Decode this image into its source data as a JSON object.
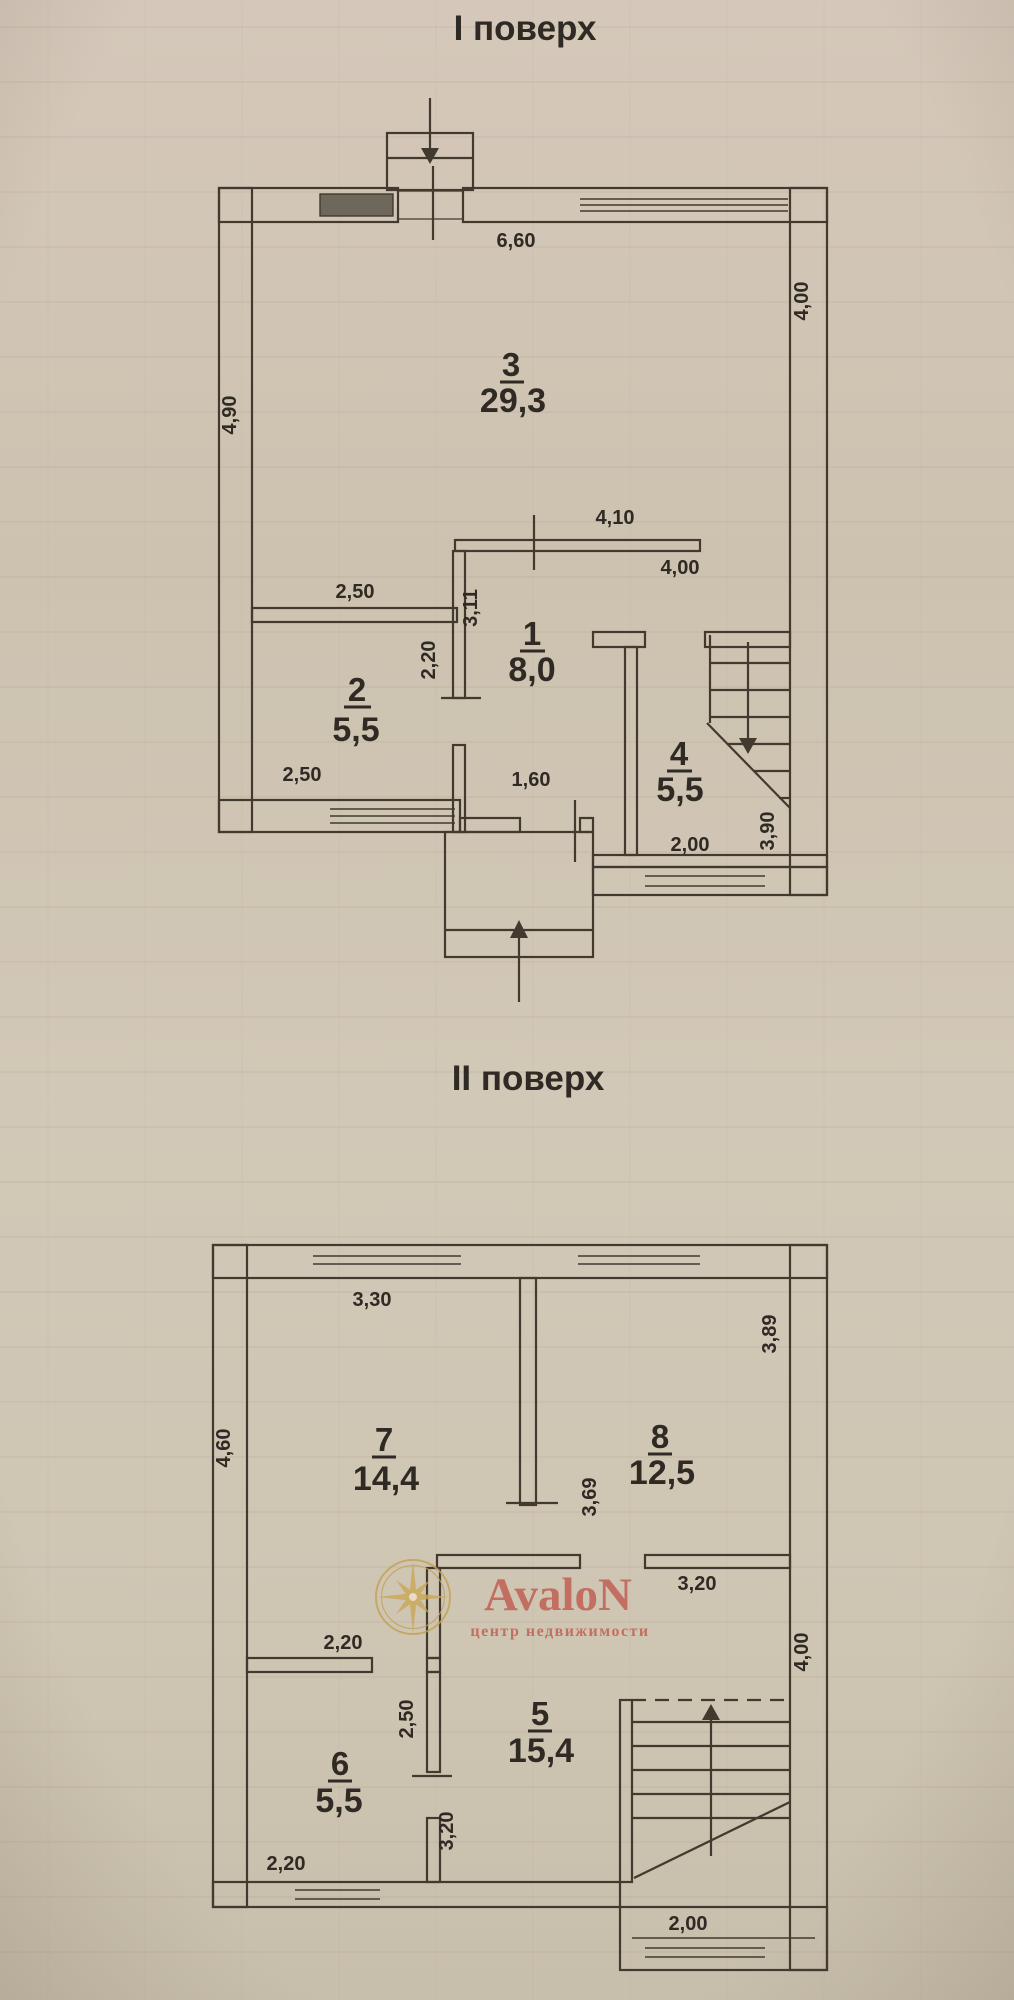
{
  "page": {
    "paper_color": "#cfc5b4",
    "line_color": "#42392f",
    "text_color": "#2f2a23"
  },
  "floor1": {
    "title": "І поверх",
    "rooms": {
      "living": {
        "num": "3",
        "area": "29,3"
      },
      "hall": {
        "num": "1",
        "area": "8,0"
      },
      "room2": {
        "num": "2",
        "area": "5,5"
      },
      "stairs": {
        "num": "4",
        "area": "5,5"
      }
    },
    "dims": {
      "top_width": "6,60",
      "left_height": "4,90",
      "right_height": "4,00",
      "hall_top": "4,10",
      "hall_right": "4,00",
      "hall_left": "3,11",
      "room2_top": "2,50",
      "room2_door": "2,20",
      "room2_bottom": "2,50",
      "hall_door": "1,60",
      "stairs_width": "2,00",
      "stairs_right": "3,90"
    }
  },
  "floor2": {
    "title": "ІІ поверх",
    "rooms": {
      "room7": {
        "num": "7",
        "area": "14,4"
      },
      "room8": {
        "num": "8",
        "area": "12,5"
      },
      "room6": {
        "num": "6",
        "area": "5,5"
      },
      "room5": {
        "num": "5",
        "area": "15,4"
      }
    },
    "dims": {
      "room7_top": "3,30",
      "left_height": "4,60",
      "right_height": "3,89",
      "room8_left": "3,69",
      "room8_bottom": "3,20",
      "room6_top": "2,20",
      "wall65_upper": "2,50",
      "wall65_lower": "3,20",
      "room6_bottom": "2,20",
      "right_lower": "4,00",
      "stairs_bottom": "2,00"
    }
  },
  "watermark": {
    "brand": "AvaloN",
    "tagline": "центр недвижимости",
    "accent": "#bf5a4d",
    "gold": "#c9a855"
  }
}
